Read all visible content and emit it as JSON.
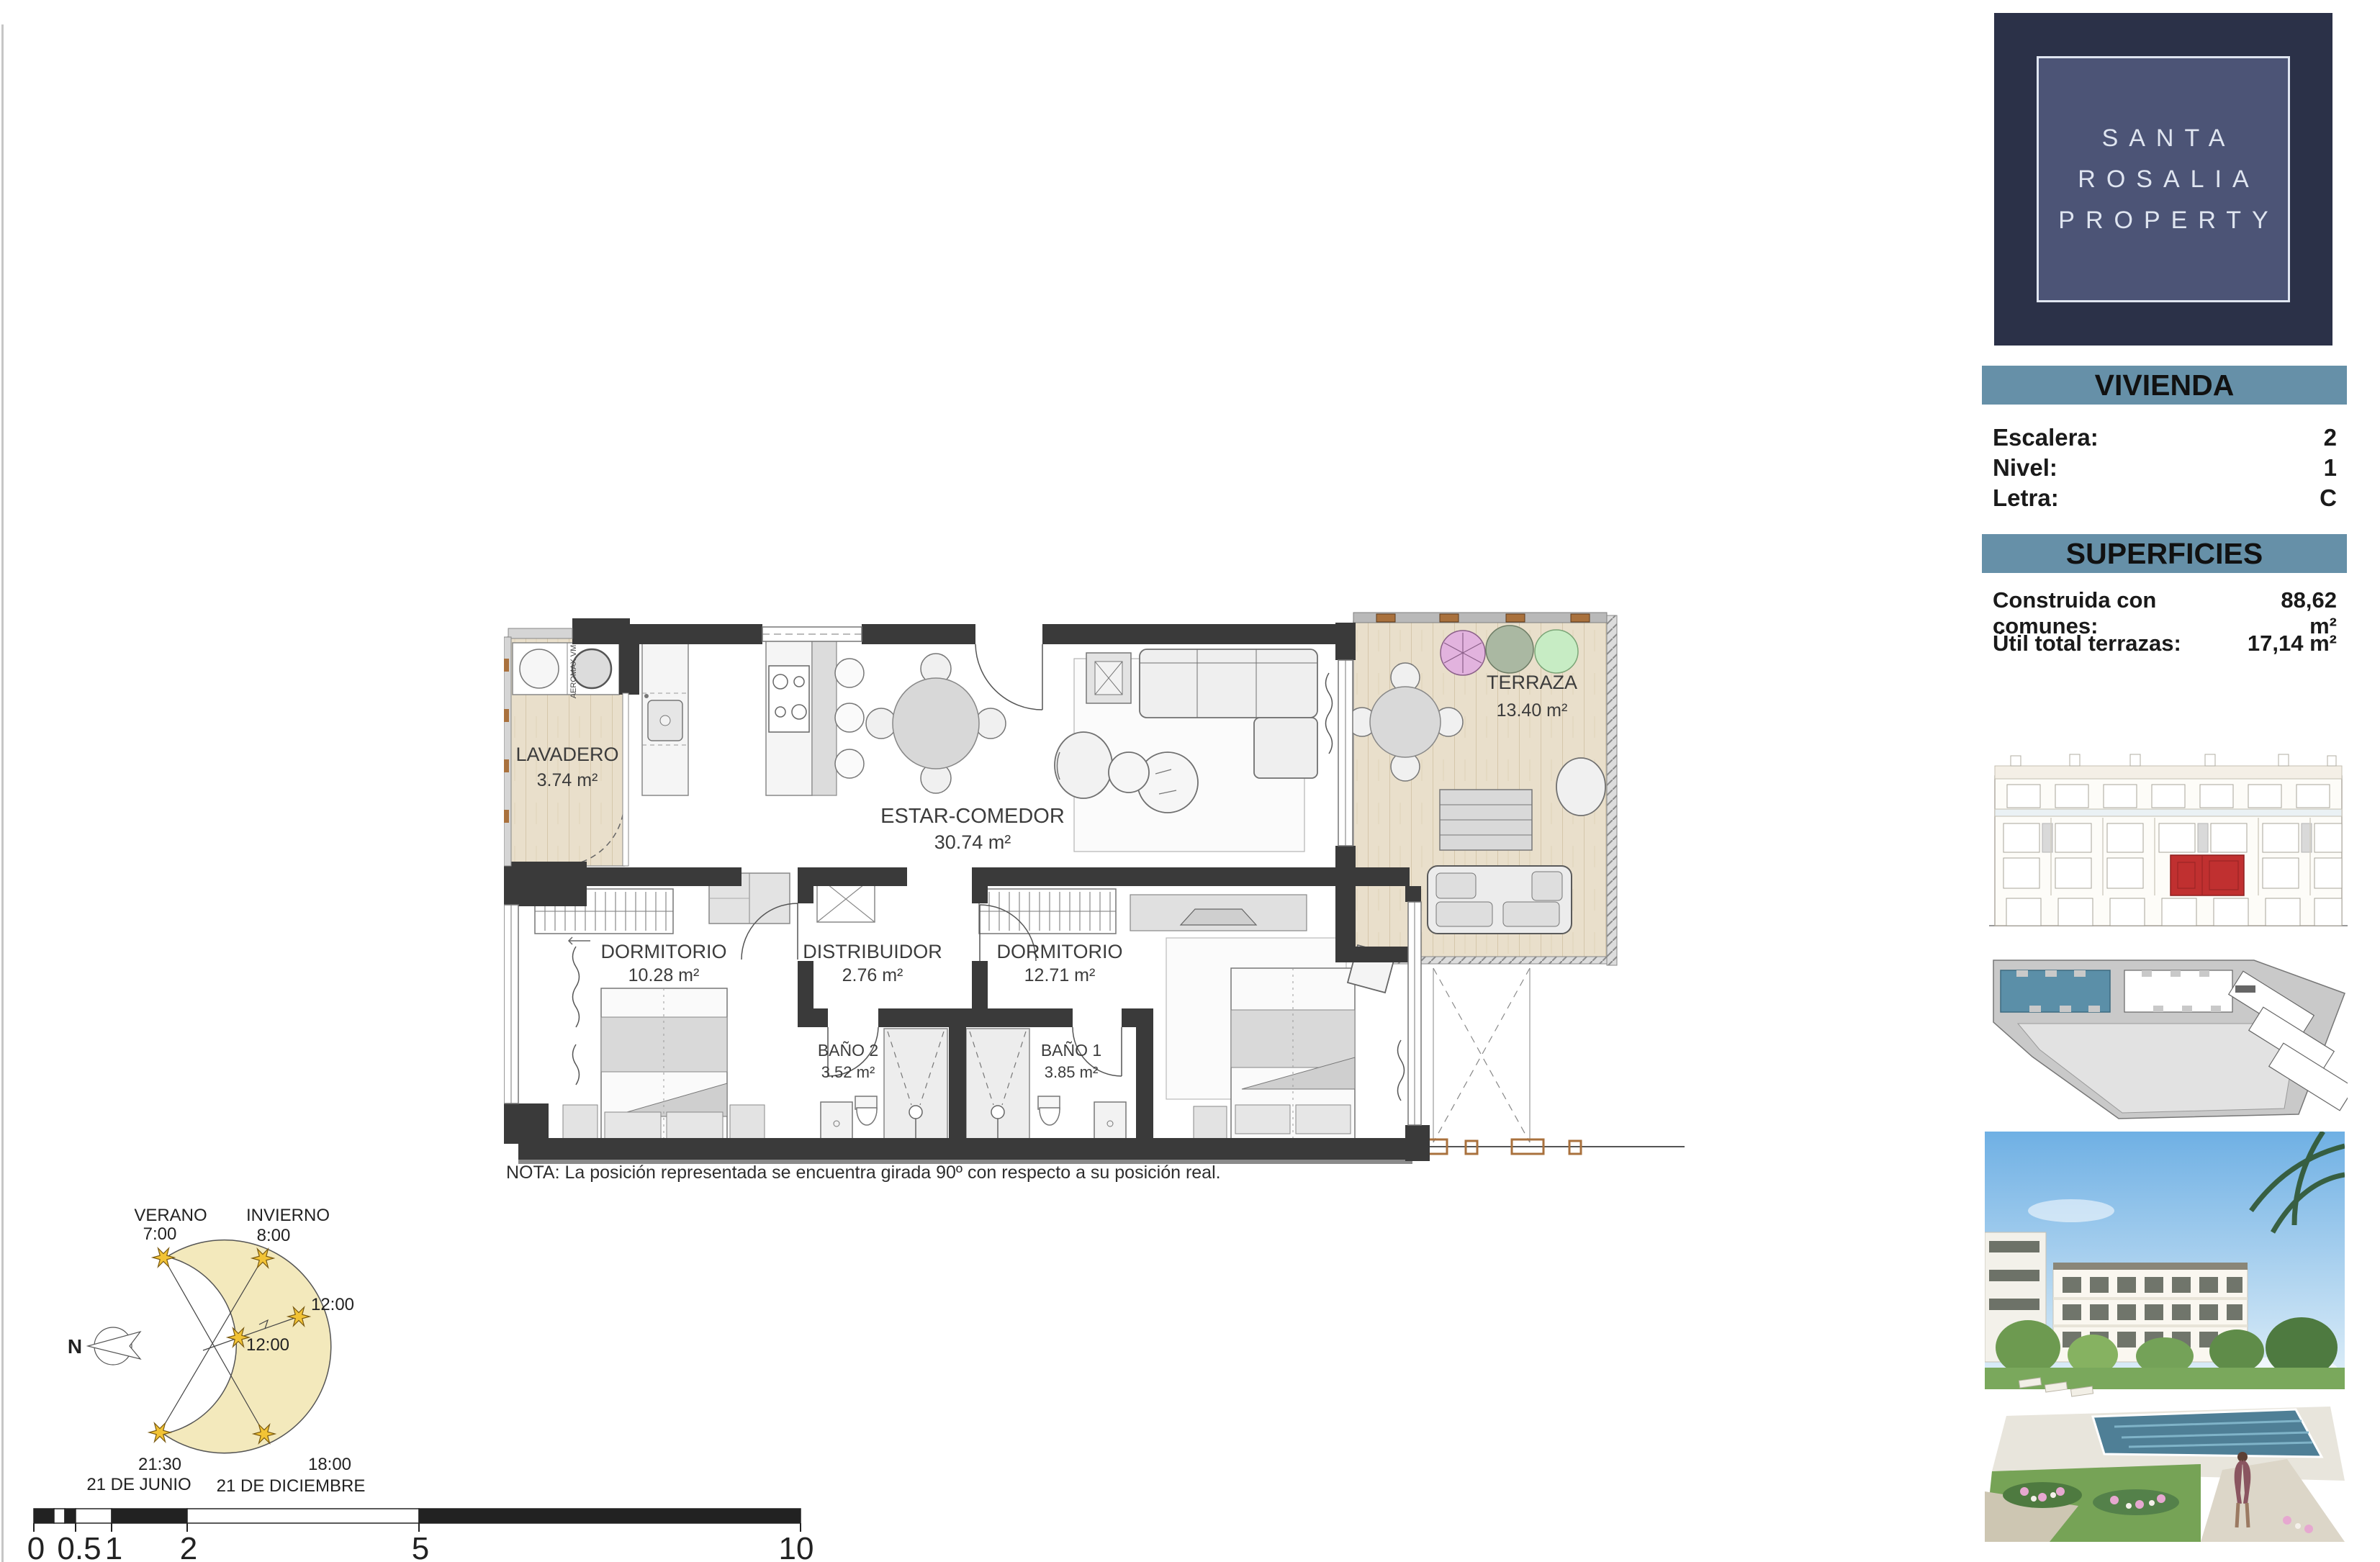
{
  "logo": {
    "line1": "SANTA",
    "line2": "ROSALIA",
    "line3": "PROPERTY"
  },
  "vivienda": {
    "title": "VIVIENDA",
    "rows": [
      {
        "label": "Escalera:",
        "value": "2"
      },
      {
        "label": "Nivel:",
        "value": "1"
      },
      {
        "label": "Letra:",
        "value": "C"
      }
    ]
  },
  "superficies": {
    "title": "SUPERFICIES",
    "rows": [
      {
        "label": "Construida con comunes:",
        "value": "88,62 m²"
      },
      {
        "label": "Útil total terrazas:",
        "value": "17,14 m²"
      }
    ]
  },
  "floorplan": {
    "note": "NOTA: La posición representada se encuentra girada 90º con respecto a su posición real.",
    "appliance": "AEROMAX VM",
    "rooms": {
      "lavadero": {
        "name": "LAVADERO",
        "area": "3.74 m²"
      },
      "estar": {
        "name": "ESTAR-COMEDOR",
        "area": "30.74 m²"
      },
      "terraza": {
        "name": "TERRAZA",
        "area": "13.40 m²"
      },
      "dormitorio1": {
        "name": "DORMITORIO",
        "area": "10.28 m²"
      },
      "distribuidor": {
        "name": "DISTRIBUIDOR",
        "area": "2.76 m²"
      },
      "dormitorio2": {
        "name": "DORMITORIO",
        "area": "12.71 m²"
      },
      "bano2": {
        "name": "BAÑO 2",
        "area": "3.52 m²"
      },
      "bano1": {
        "name": "BAÑO 1",
        "area": "3.85 m²"
      }
    }
  },
  "sun_diagram": {
    "verano": "VERANO",
    "verano_time": "7:00",
    "invierno": "INVIERNO",
    "invierno_time": "8:00",
    "noon_invierno": "12:00",
    "noon_verano": "12:00",
    "junio_time": "21:30",
    "junio_date": "21 DE JUNIO",
    "diciembre_time": "18:00",
    "diciembre_date": "21 DE DICIEMBRE",
    "north": "N"
  },
  "scale_bar": {
    "labels": [
      "0",
      "0.5",
      "1",
      "2",
      "5",
      "10"
    ]
  },
  "colors": {
    "header_bar": "#6690a8",
    "logo_bg": "#2b3148",
    "logo_inner": "#4c5476",
    "unit_highlight_red": "#c03030",
    "building_highlight_blue": "#5b8fa8",
    "wall": "#3a3a3a",
    "wood": "#e9dfcb"
  }
}
